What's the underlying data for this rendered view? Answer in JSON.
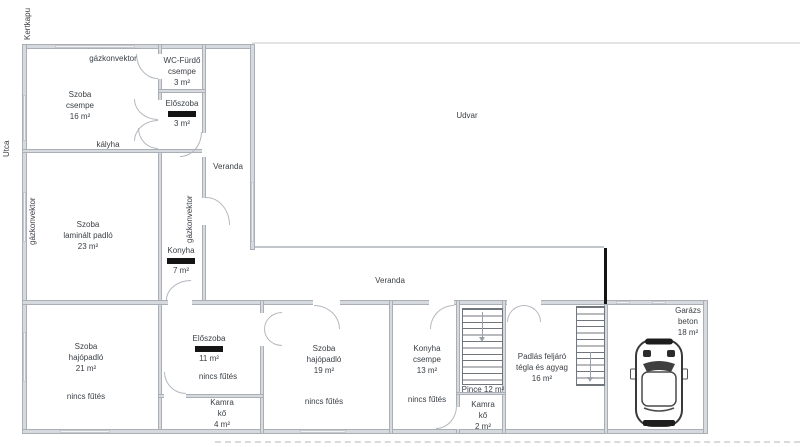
{
  "colors": {
    "wall_fill": "#d6d9dd",
    "wall_edge": "#aaafb6",
    "redaction": "#141414",
    "text": "#3b4046"
  },
  "labels": {
    "kertkapu": "Kertkapu",
    "utca": "Utca",
    "udvar": "Udvar",
    "veranda_upper": "Veranda",
    "veranda_lower": "Veranda",
    "gazkonvektor_top": "gázkonvektor",
    "gazkonvektor_left": "gázkonvektor",
    "gazkonvektor_middle": "gázkonvektor",
    "kalyha": "kályha"
  },
  "rooms": {
    "szoba_csempe": {
      "lines": [
        "Szoba",
        "csempe",
        "16 m²"
      ]
    },
    "wc_furdo": {
      "lines": [
        "WC-Fürdő",
        "csempe",
        "3 m²"
      ]
    },
    "eloszoba_felso": {
      "name": "Előszoba",
      "area": "3 m²",
      "redacted": true
    },
    "szoba_laminalt": {
      "lines": [
        "Szoba",
        "laminált padló",
        "23 m²"
      ]
    },
    "konyha_felso": {
      "name": "Konyha",
      "area": "7 m²",
      "redacted": true
    },
    "szoba_21": {
      "lines": [
        "Szoba",
        "hajópadló",
        "21 m²"
      ],
      "note": "nincs fűtés"
    },
    "eloszoba_also": {
      "name": "Előszoba",
      "area": "11 m²",
      "note": "nincs fűtés",
      "redacted": true
    },
    "kamra_4": {
      "lines": [
        "Kamra",
        "kő",
        "4 m²"
      ]
    },
    "szoba_19": {
      "lines": [
        "Szoba",
        "hajópadló",
        "19 m²"
      ],
      "note": "nincs fűtés"
    },
    "konyha_also": {
      "lines": [
        "Konyha",
        "csempe",
        "13 m²"
      ],
      "note": "nincs fűtés"
    },
    "pince": {
      "label": "Pince 12 m²"
    },
    "kamra_2": {
      "lines": [
        "Kamra",
        "kő",
        "2 m²"
      ]
    },
    "padlas_feljaro": {
      "lines": [
        "Padlás feljáró",
        "tégla és agyag",
        "16 m²"
      ]
    },
    "garazs": {
      "lines": [
        "Garázs",
        "beton",
        "18 m²"
      ]
    }
  }
}
